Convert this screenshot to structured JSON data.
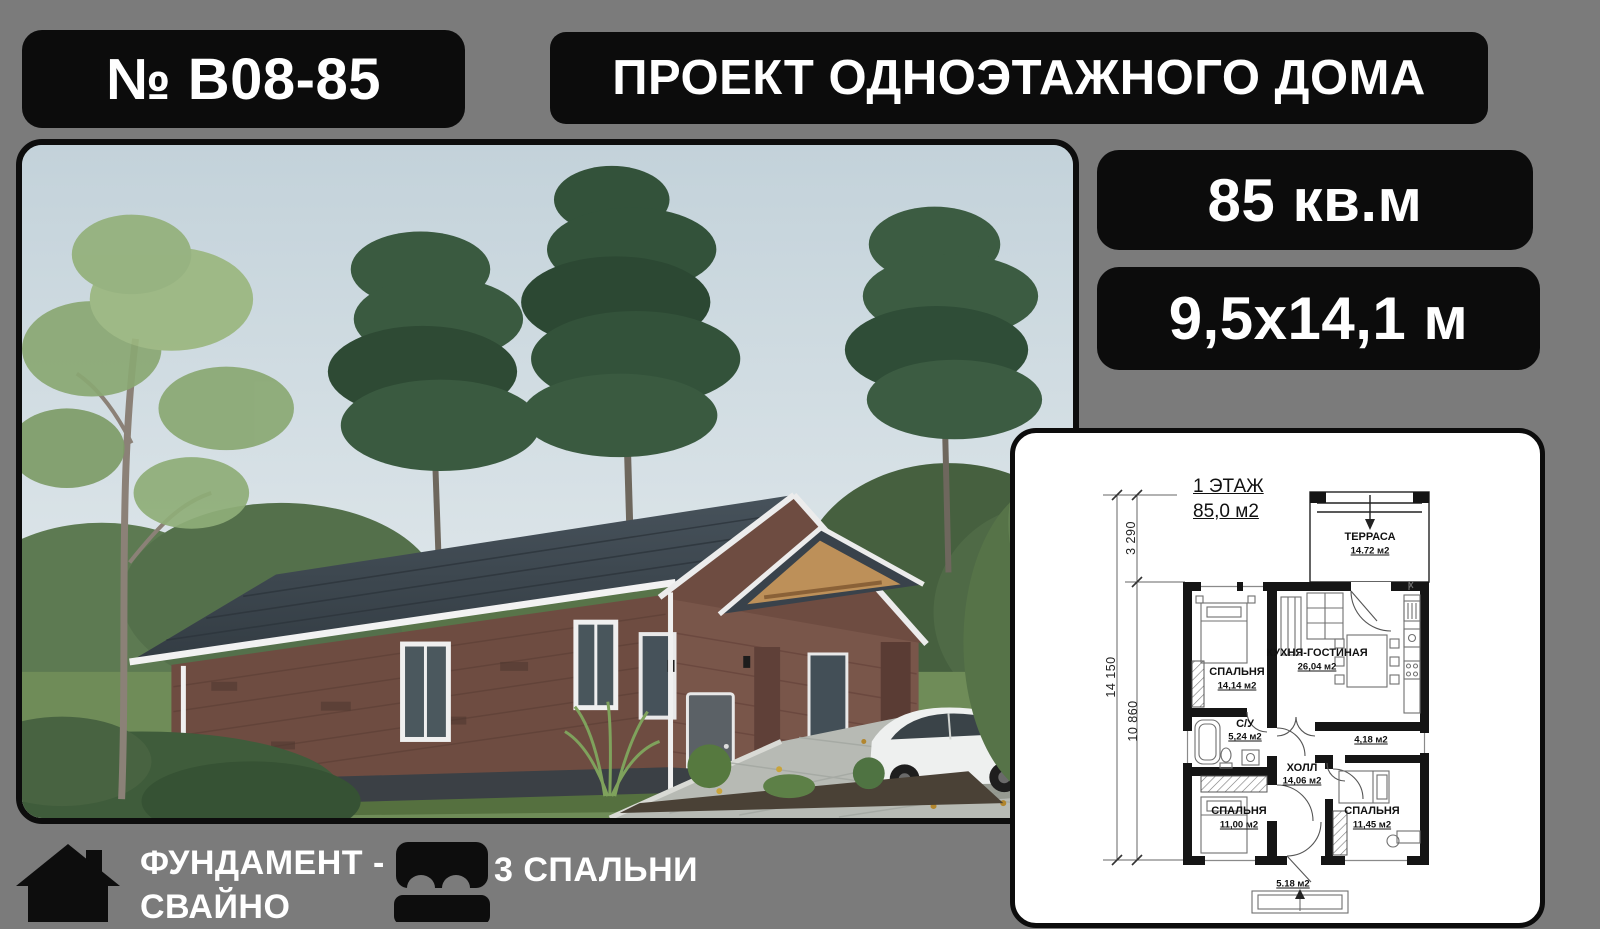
{
  "header": {
    "project_number": "№ B08-85",
    "title": "ПРОЕКТ ОДНОЭТАЖНОГО ДОМА"
  },
  "badges": {
    "area": "85 кв.м",
    "dimensions": "9,5x14,1 м"
  },
  "features": {
    "foundation": {
      "line1": "ФУНДАМЕНТ -",
      "line2": "СВАЙНО"
    },
    "bedrooms": {
      "label": "3 СПАЛЬНИ"
    }
  },
  "floor_plan": {
    "title_line1": "1 ЭТАЖ",
    "title_line2": "85,0 м2",
    "dims": {
      "upper": "3 290",
      "total": "14 150",
      "lower": "10 860"
    },
    "rooms": {
      "terrace": {
        "name": "ТЕРРАСА",
        "area": "14.72 м2"
      },
      "bedroom1": {
        "name": "СПАЛЬНЯ",
        "area": "14,14 м2"
      },
      "kitchen": {
        "name": "КУХНЯ-ГОСТИНАЯ",
        "area": "26,04 м2"
      },
      "bathroom": {
        "name": "С/У",
        "area": "5,24 м2"
      },
      "storage": {
        "area": "4,18 м2"
      },
      "hall": {
        "name": "ХОЛЛ",
        "area": "14,06 м2"
      },
      "bedroom2": {
        "name": "СПАЛЬНЯ",
        "area": "11,00 м2"
      },
      "bedroom3": {
        "name": "СПАЛЬНЯ",
        "area": "11,45 м2"
      },
      "porch": {
        "area": "5.18 м2"
      }
    }
  },
  "colors": {
    "background": "#7b7b7b",
    "panel_black": "#0c0c0c",
    "text_on_dark": "#ffffff",
    "card_background": "#ffffff",
    "plan_ink": "#151515"
  }
}
